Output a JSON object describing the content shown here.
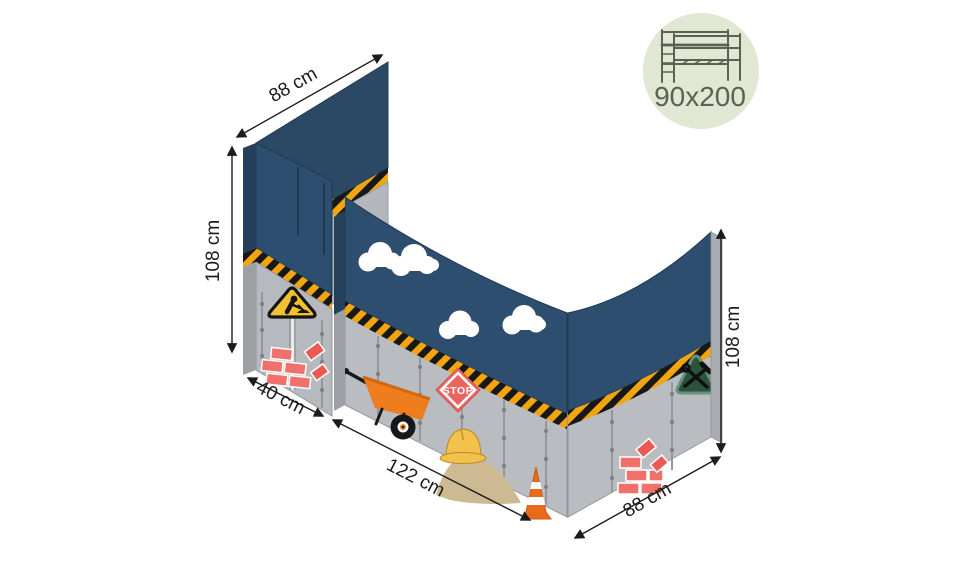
{
  "illustration": {
    "description": "construction-themed loft-bed curtain set shown in perspective with dimension arrows",
    "dimension_labels": {
      "rear_left_width": "88 cm",
      "left_height": "108 cm",
      "front_left_width": "40 cm",
      "front_width": "122 cm",
      "right_width": "88 cm",
      "right_height": "108 cm"
    },
    "stop_sign_label": "STOP",
    "theme_elements": [
      "clouds",
      "hazard-stripe",
      "roadworks-sign",
      "bricks",
      "wheelbarrow",
      "stop-sign",
      "hard-hat",
      "sand-pile",
      "traffic-cone",
      "tools-sign"
    ],
    "colors": {
      "canvas_blue": "#2e4e70",
      "rear_canvas_blue": "#2b4965",
      "panel_grey": "#b9bcc0",
      "edge_grey": "#9da1a6",
      "hazard_yellow": "#f3a50f",
      "hazard_black": "#181818",
      "brick_red": "#f0716c",
      "accent_orange": "#ef7d1e",
      "helmet_yellow": "#f2c14e",
      "sand_tan": "#cdb992",
      "warning_sign_yellow": "#f2c12f",
      "tools_sign_green": "#2a523d"
    }
  },
  "badge": {
    "size_label": "90x200",
    "background": "#e0e8d3",
    "foreground": "#5a6352",
    "icon": "loft-bed-frame"
  }
}
